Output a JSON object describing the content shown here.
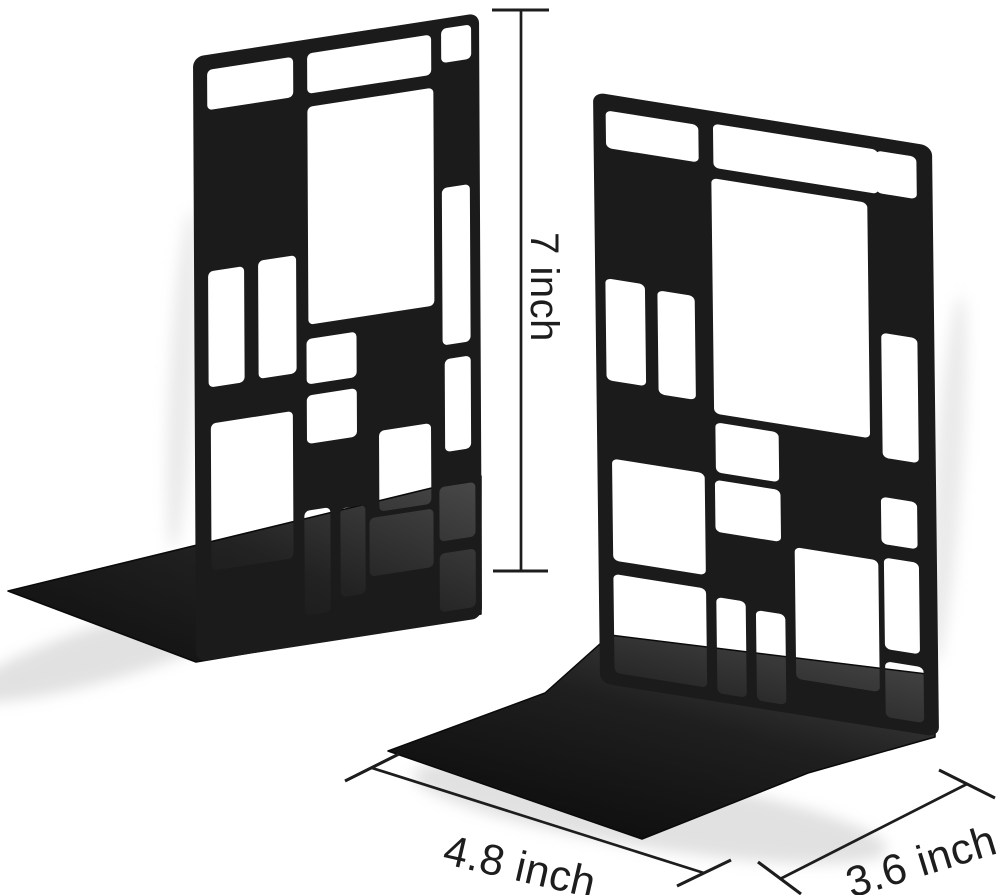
{
  "image": {
    "subject": "Pair of black metal Mondrian-grid bookends shown on a white background with printed size dimensions",
    "background_color": "#ffffff"
  },
  "colors": {
    "metal_black": "#1b1b1b",
    "base_dark": "#0e0e0e",
    "base_light": "#4a4a4a",
    "dimension_line": "#1d1d1d",
    "label_text": "#1d1d1d",
    "shadow": "#c9c9c9"
  },
  "dimension_labels": {
    "height": "7 inch",
    "width": "4.8 inch",
    "depth": "3.6 inch"
  }
}
